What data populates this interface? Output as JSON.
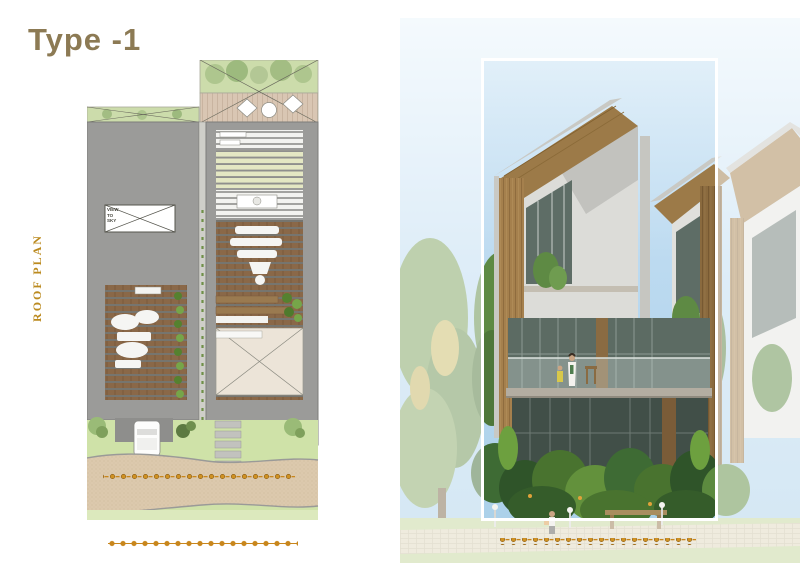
{
  "title": "Type -1",
  "plan": {
    "label": "ROOF PLAN",
    "view_to_sky": "VIEW TO SKY",
    "features": [
      "roof terrace with deck and loungers",
      "two gray roof wings with louvered skylights",
      "garden with curved path",
      "car port",
      "stepping stones"
    ]
  },
  "render": {
    "subject": "three-storey modern villa with angled wood portal frames",
    "highlight": "selected unit outlined with white rectangle, surroundings faded"
  },
  "colors": {
    "title_text": "#8c7a54",
    "side_label_text": "#bb8a1f",
    "boundary_gold": "#c8861c",
    "roof_gray": "#9b9b99",
    "slat_wood": "#8a6848",
    "slat_cream": "#e4e7c3",
    "deck_wood": "#d9c6b3",
    "lawn_green": "#cfe2a8",
    "path_sand": "#dcc9ad",
    "sky_blue": "#aed3ec",
    "portal_wood": "#a5804d",
    "glass_teal": "#5c6b63",
    "highlight_border": "#ffffff",
    "page_background": "#ffffff"
  }
}
